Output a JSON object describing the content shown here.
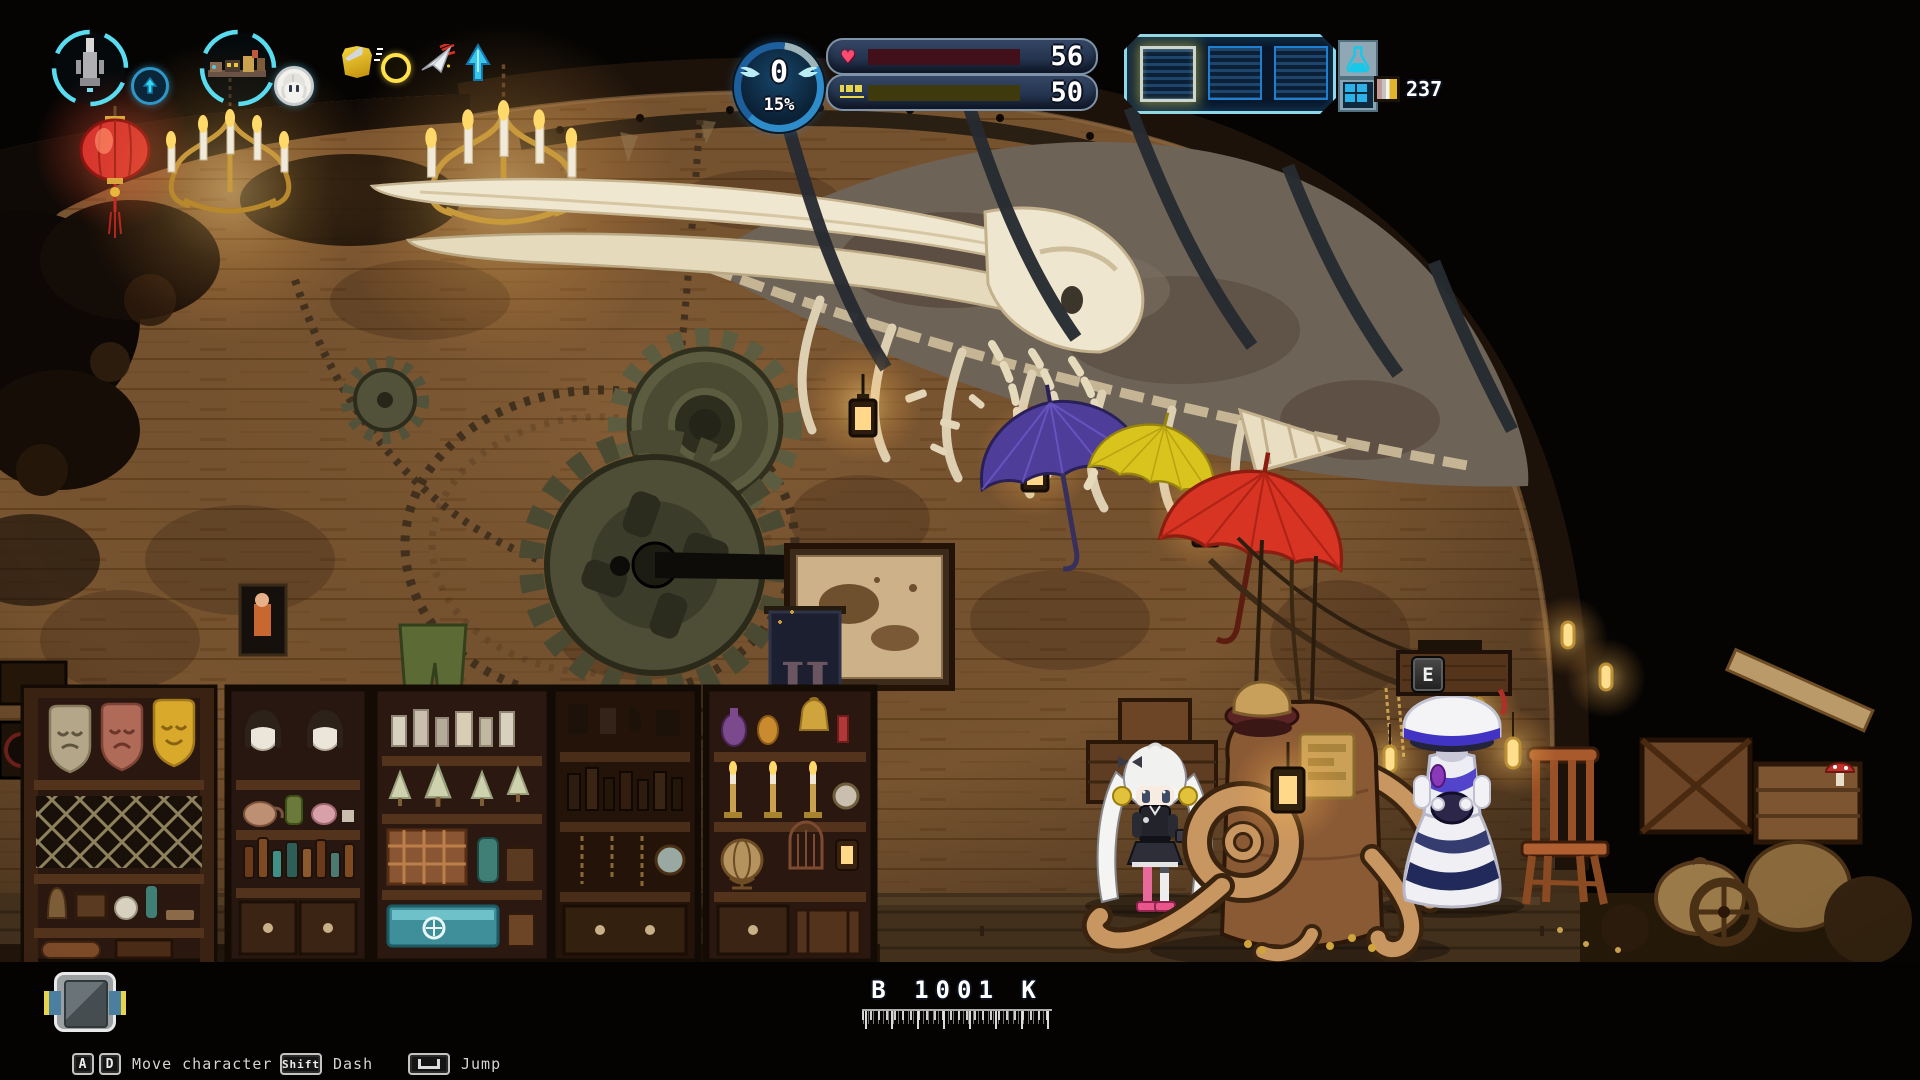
{
  "hud": {
    "squad": {
      "ring1": {
        "icon": "monument-sprite",
        "badge_icon": "up-arrow"
      },
      "ring2": {
        "icon": "convoy-sprite",
        "badge_icon": "girl-portrait"
      }
    },
    "buff_icons": [
      "shield",
      "coin",
      "paper-plane",
      "ascend-arrow"
    ],
    "level_badge": {
      "value": "0",
      "progress": "15%"
    },
    "bars": [
      {
        "id": "hp",
        "icon": "heart-icon",
        "glyph": "♥",
        "value": "56",
        "fill_pct": 57,
        "fill_color": "#e8192c"
      },
      {
        "id": "fuel",
        "icon": "fuel-icon",
        "value": "50",
        "fill_pct": 52,
        "fill_color": "#f5b81c"
      }
    ],
    "hotbar": {
      "slot_count": 3,
      "highlighted_slot": 1,
      "buttons": [
        "flask",
        "grid"
      ]
    },
    "resource": {
      "icon": "ingot-stack-icon",
      "count": "237"
    },
    "interact_key": "E",
    "depth_label": "B 1001 K",
    "bag_icon": "backpack-icon",
    "hints": [
      {
        "keys": [
          "A",
          "D"
        ],
        "label": "Move character"
      },
      {
        "keys": [
          "Shift"
        ],
        "label": "Dash"
      },
      {
        "keys": [
          "Space"
        ],
        "label": "Jump"
      }
    ]
  },
  "scene": {
    "banner_monogram": "IJ"
  }
}
